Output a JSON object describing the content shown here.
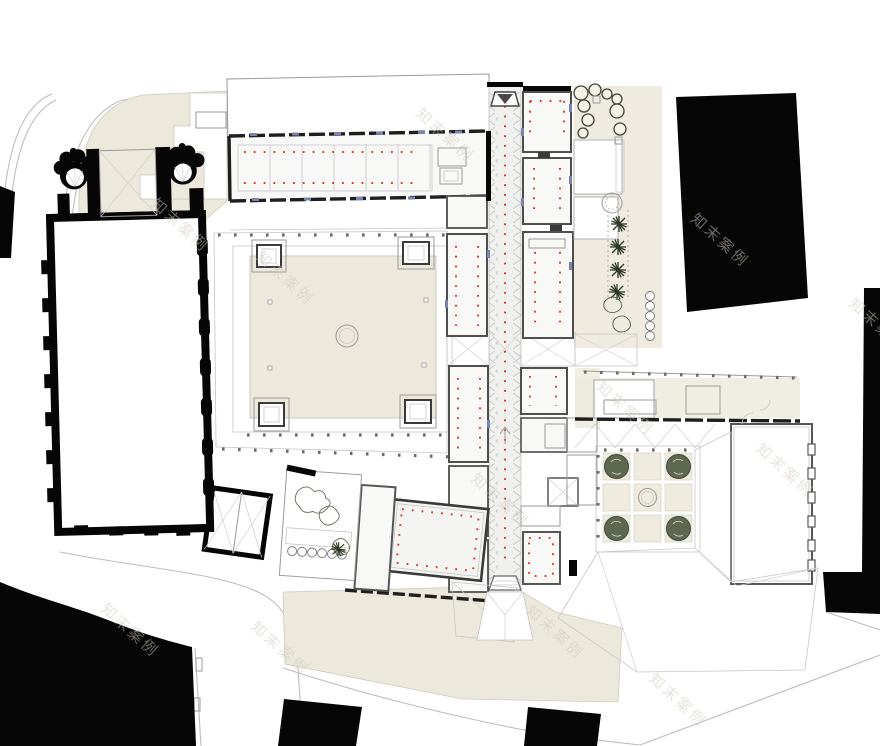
{
  "document": {
    "title": "museum-site-plan",
    "drawing_type": "architectural ground floor site plan"
  },
  "watermark": {
    "text": "知末案例",
    "color": "#CFC9BC"
  },
  "colors": {
    "paper": "#FFFFFF",
    "beige": "#ECE8DC",
    "beige_light": "#F1EDE2",
    "black": "#060606",
    "roof_gray": "#E4E4E2",
    "hatch_line": "#C9C9C9",
    "corridor_fill": "#F0F0EF",
    "wall_dark": "#1E1E1E",
    "wall_mid": "#565656",
    "line_light": "#BDBDBD",
    "red": "#D93A32",
    "navy": "#7B84AE",
    "tree_dark": "#5E6850",
    "conifer": "#2F3A26"
  },
  "plan": {
    "regions": [
      "church-nave",
      "church-chapels",
      "crossing-tower",
      "cloister-courtyard",
      "cloister-arcade",
      "north-gallery-wing",
      "north-gallery-roof",
      "central-corridor",
      "east-gallery-rooms",
      "west-gallery-rooms",
      "corridor-crossing",
      "great-red-room",
      "chapter-garden",
      "east-sculpture-garden",
      "parterre-tree-courtyard",
      "southeast-hall",
      "roofscape",
      "context-building-northeast",
      "context-building-east",
      "context-building-southwest",
      "context-buildings-south",
      "streets",
      "south-plaza",
      "north-terrace"
    ],
    "symbols": [
      "red-dot-grid",
      "chevron-skylight-edge",
      "stair-treads",
      "tree-round",
      "tree-conifer",
      "column-dot-row"
    ]
  }
}
